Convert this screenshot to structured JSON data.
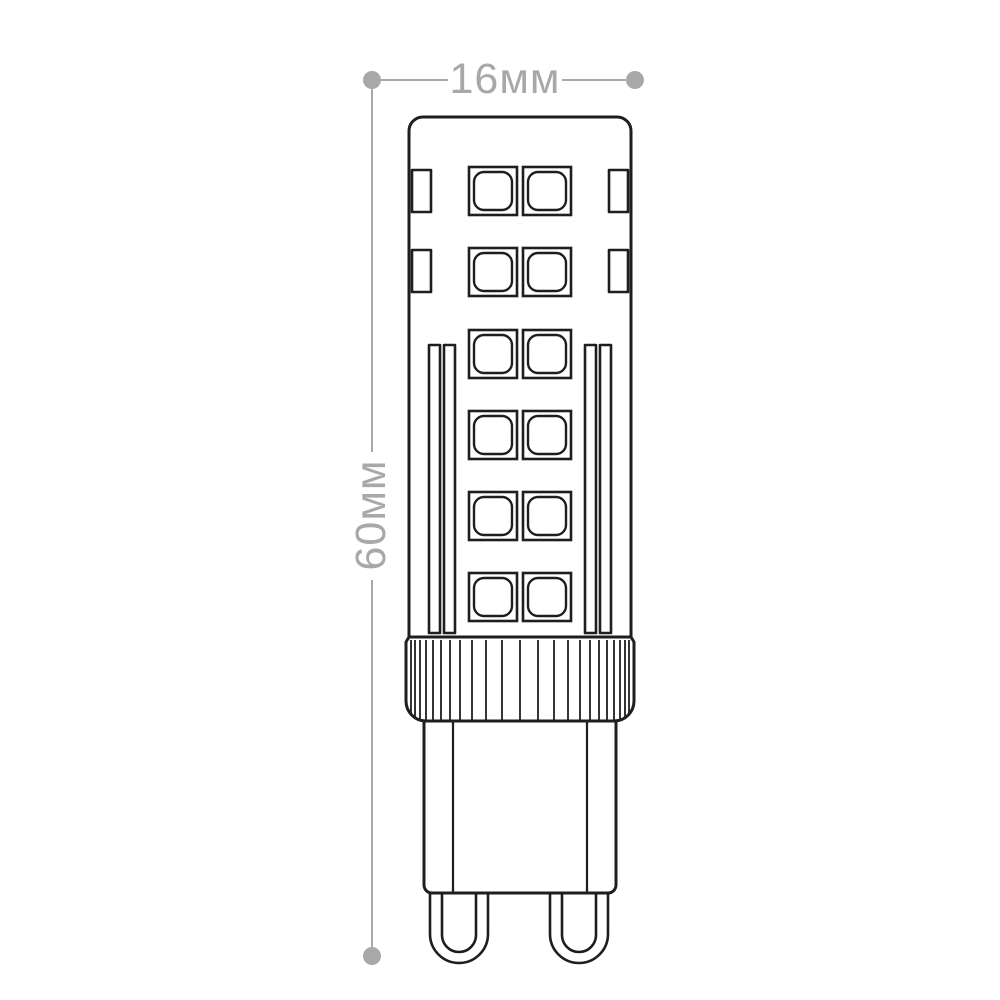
{
  "page": {
    "background": "#ffffff"
  },
  "diagram": {
    "colors": {
      "line": "#1e1e1e",
      "dimension": "#a8a8a8",
      "fill": "#ffffff"
    },
    "dimensions": {
      "width": {
        "label": "16мм"
      },
      "height": {
        "label": "60мм"
      }
    },
    "lamp": {
      "led_grid": {
        "rows_y": [
          167,
          248,
          330,
          411,
          492,
          573
        ],
        "cols_x": [
          469,
          523
        ],
        "size": 48,
        "inner_inset": 5,
        "inner_radius": 10
      },
      "side_leds": {
        "rows_y": [
          170,
          250
        ],
        "left_x": 412,
        "right_x": 609,
        "w": 19,
        "h": 42
      },
      "strips": {
        "xs": [
          429,
          444,
          585,
          600
        ],
        "y": 345,
        "w": 11,
        "h": 288
      },
      "collar_ribs": {
        "xs": [
          411,
          415,
          420,
          426,
          433,
          441,
          450,
          460,
          472,
          486,
          502,
          520,
          538,
          554,
          568,
          580,
          590,
          599,
          607,
          614,
          620,
          625,
          629
        ],
        "y1": 640,
        "y2": 720
      }
    }
  }
}
